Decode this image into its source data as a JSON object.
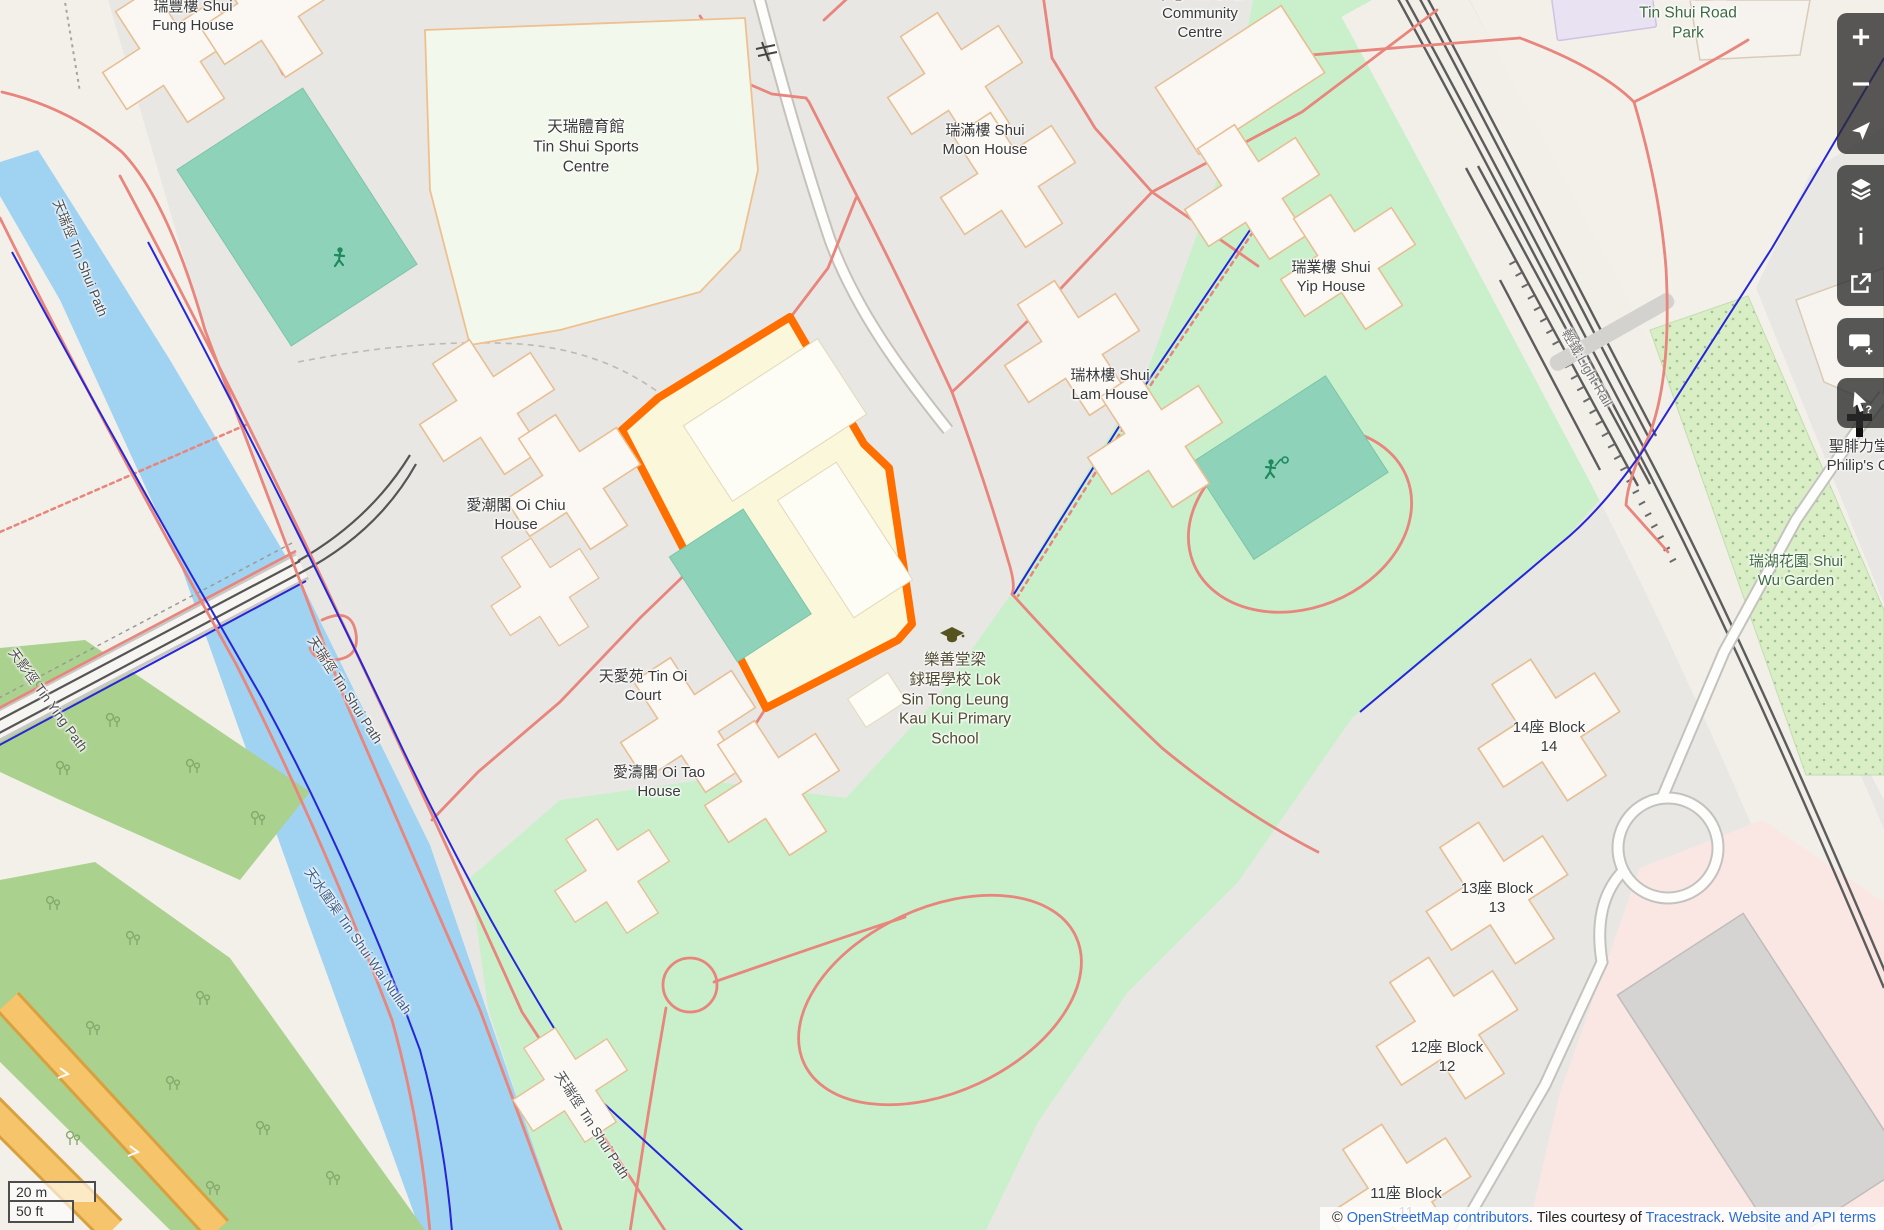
{
  "map": {
    "colors": {
      "selection_orange": "#ff6f00",
      "school_fill": "#fbf7da",
      "park_green": "#c9f0cb",
      "water_blue": "#a0d2f2",
      "pitch_teal": "#8fd2ba",
      "path_salmon": "#e8857c",
      "fence_blue": "#2626d8",
      "control_bg": "rgba(42,42,42,0.78)",
      "link_blue": "#2b6ed9"
    },
    "labels": [
      {
        "id": "label-shui-fung-house",
        "lines": [
          "瑞豐樓 Shui",
          "Fung House"
        ],
        "x": 193,
        "y": 16,
        "rot": 0,
        "cls": "dark",
        "size": 15
      },
      {
        "id": "label-tin-shui-sports-centre",
        "lines": [
          "天瑞體育館",
          "Tin Shui Sports",
          "Centre"
        ],
        "x": 586,
        "y": 147,
        "rot": 0,
        "cls": "dark",
        "size": 15.5
      },
      {
        "id": "label-shui-moon-house",
        "lines": [
          "瑞滿樓 Shui",
          "Moon House"
        ],
        "x": 985,
        "y": 140,
        "rot": 0,
        "cls": "dark",
        "size": 15
      },
      {
        "id": "label-community-centre",
        "lines": [
          "中心 Tin Shui",
          "Community",
          "Centre"
        ],
        "x": 1200,
        "y": 14,
        "rot": 0,
        "cls": "dark",
        "size": 15
      },
      {
        "id": "label-shui-yip-house",
        "lines": [
          "瑞業樓 Shui",
          "Yip House"
        ],
        "x": 1331,
        "y": 277,
        "rot": 0,
        "cls": "dark",
        "size": 15
      },
      {
        "id": "label-shui-lam-house",
        "lines": [
          "瑞林樓 Shui",
          "Lam House"
        ],
        "x": 1110,
        "y": 385,
        "rot": 0,
        "cls": "dark",
        "size": 15
      },
      {
        "id": "label-oi-chiu-house",
        "lines": [
          "愛潮閣 Oi Chiu",
          "House"
        ],
        "x": 516,
        "y": 515,
        "rot": 0,
        "cls": "dark",
        "size": 15
      },
      {
        "id": "label-tin-oi-court",
        "lines": [
          "天愛苑 Tin Oi",
          "Court"
        ],
        "x": 643,
        "y": 686,
        "rot": 0,
        "cls": "dark",
        "size": 15
      },
      {
        "id": "label-oi-tao-house",
        "lines": [
          "愛濤閣 Oi Tao",
          "House"
        ],
        "x": 659,
        "y": 782,
        "rot": 0,
        "cls": "dark",
        "size": 15
      },
      {
        "id": "label-school",
        "lines": [
          "樂善堂梁",
          "銶琚學校 Lok",
          "Sin Tong Leung",
          "Kau Kui Primary",
          "School"
        ],
        "x": 955,
        "y": 700,
        "rot": 0,
        "cls": "school",
        "size": 15.5
      },
      {
        "id": "label-tin-shui-road-park",
        "lines": [
          "天瑞路公園",
          "Tin Shui Road",
          "Park"
        ],
        "x": 1688,
        "y": 13,
        "rot": 0,
        "cls": "green",
        "size": 15.5
      },
      {
        "id": "label-shui-wu-garden",
        "lines": [
          "瑞湖花園 Shui",
          "Wu Garden"
        ],
        "x": 1796,
        "y": 571,
        "rot": 0,
        "cls": "green",
        "size": 15
      },
      {
        "id": "label-st-philips-church",
        "lines": [
          "聖腓力堂 S",
          "Philip's Chu"
        ],
        "x": 1866,
        "y": 456,
        "rot": 0,
        "cls": "dark",
        "size": 15
      },
      {
        "id": "label-block-14",
        "lines": [
          "14座 Block",
          "14"
        ],
        "x": 1549,
        "y": 737,
        "rot": 0,
        "cls": "dark",
        "size": 15
      },
      {
        "id": "label-block-13",
        "lines": [
          "13座 Block",
          "13"
        ],
        "x": 1497,
        "y": 898,
        "rot": 0,
        "cls": "dark",
        "size": 15
      },
      {
        "id": "label-block-12",
        "lines": [
          "12座 Block",
          "12"
        ],
        "x": 1447,
        "y": 1057,
        "rot": 0,
        "cls": "dark",
        "size": 15
      },
      {
        "id": "label-block-11",
        "lines": [
          "11座 Block",
          "11"
        ],
        "x": 1406,
        "y": 1203,
        "rot": 0,
        "cls": "dark",
        "size": 15
      },
      {
        "id": "label-tin-shui-path-west",
        "lines": [
          "天瑞徑 Tin Shui Path"
        ],
        "x": 80,
        "y": 258,
        "rot": 68,
        "cls": "road",
        "size": 13.5
      },
      {
        "id": "label-tin-ying-path",
        "lines": [
          "天影徑 Tin Ying Path"
        ],
        "x": 48,
        "y": 700,
        "rot": 54,
        "cls": "road",
        "size": 13.5
      },
      {
        "id": "label-tin-shui-path-mid",
        "lines": [
          "天瑞徑 Tin Shui Path"
        ],
        "x": 345,
        "y": 690,
        "rot": 57,
        "cls": "road",
        "size": 13.5
      },
      {
        "id": "label-tin-shui-wai-nullah",
        "lines": [
          "天水圍渠 Tin Shui Wai Nullah"
        ],
        "x": 358,
        "y": 941,
        "rot": 55,
        "cls": "water",
        "size": 13.5
      },
      {
        "id": "label-tin-shui-path-south",
        "lines": [
          "天瑞徑 Tin Shui Path"
        ],
        "x": 592,
        "y": 1125,
        "rot": 57,
        "cls": "road",
        "size": 13.5
      },
      {
        "id": "label-light-rail",
        "lines": [
          "輕鐵:Light Rail"
        ],
        "x": 1587,
        "y": 368,
        "rot": 60,
        "cls": "rail",
        "size": 13.5
      }
    ],
    "controls": [
      {
        "icon": "zoom-in-icon",
        "y": 13,
        "h": 47,
        "corner": "top"
      },
      {
        "icon": "zoom-out-icon",
        "y": 60,
        "h": 47,
        "corner": "none"
      },
      {
        "icon": "locate-icon",
        "y": 107,
        "h": 47,
        "corner": "bottom"
      },
      {
        "icon": "layers-icon",
        "y": 165,
        "h": 47,
        "corner": "top"
      },
      {
        "icon": "info-icon",
        "y": 212,
        "h": 47,
        "corner": "none"
      },
      {
        "icon": "share-icon",
        "y": 259,
        "h": 47,
        "corner": "bottom"
      },
      {
        "icon": "add-note-icon",
        "y": 318,
        "h": 49,
        "corner": "both"
      },
      {
        "icon": "query-features-icon",
        "y": 378,
        "h": 50,
        "corner": "both"
      }
    ],
    "scalebar": {
      "metric": "20 m",
      "imperial": "50 ft"
    },
    "attribution": {
      "prefix": "© ",
      "link_osm": "OpenStreetMap contributors",
      "mid1": ". Tiles courtesy of ",
      "link_tiles": "Tracestrack",
      "mid2": ". ",
      "link_terms": "Website and API terms"
    }
  }
}
